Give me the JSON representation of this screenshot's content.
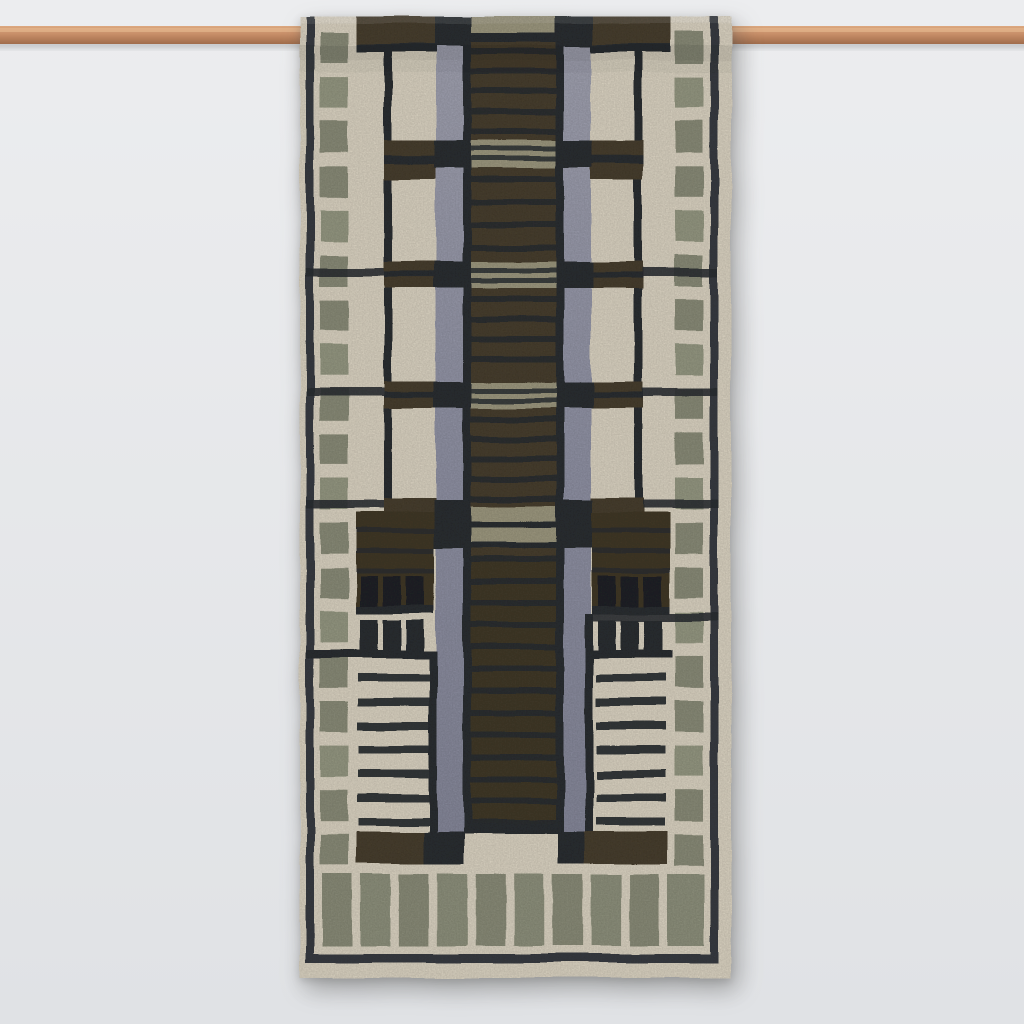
{
  "scene": {
    "type": "product-photograph",
    "subject": "Handwoven geometric kilim wall hanging draped over a copper pipe rail",
    "style": "Art-deco / Frank Lloyd Wright skyscraper motif, mirror-symmetric",
    "background": "plain pale grey studio wall",
    "visible_text": ""
  },
  "palette": {
    "bg_top": "#ecedef",
    "bg_bottom": "#e0e2e5",
    "cream": "#e4dcca",
    "cream_bright": "#ece5d5",
    "cream_shade": "#d8d0be",
    "charcoal": "#2c3034",
    "charcoal_soft": "#3a3e44",
    "pane": "#1f2428",
    "brown": "#4b4130",
    "brown_deep": "#3e3727",
    "brown_block": "#433a29",
    "olive": "#8f917d",
    "olive_light": "#9b9e87",
    "olive_bar": "#939681",
    "tan": "#a39e84",
    "lavender": "#9698ab",
    "lavender_light": "#a7a8b7",
    "lavender_deep": "#8b8da0",
    "copper": "#c78e68",
    "copper_light": "#dca87f",
    "copper_dark": "#a06c4b"
  },
  "rod": {
    "y": 26,
    "height": 18,
    "spans_full_width": true
  },
  "rug": {
    "x": 300,
    "y": 17,
    "width": 431,
    "height": 961,
    "counts": {
      "border_squares_per_side": 19,
      "bottom_bars": 10,
      "window_panes_per_row": 3,
      "window_rows_per_side": 2,
      "ladder_stripes_per_side": 8,
      "tan_cross_bands": 4
    },
    "geometry": {
      "top": 17,
      "bottom": 978,
      "left_edge": 300,
      "right_edge": 731,
      "border_line_w": 8,
      "border_left_x": 306,
      "border_right_x": 710,
      "bottom_line_y": 954,
      "bottom_line_h": 9,
      "squares": {
        "left_x": 320,
        "right_x": 675,
        "w": 28,
        "h": 31,
        "y0": 32,
        "step": 44.6,
        "count": 19
      },
      "inner_line": {
        "left_x": 384,
        "right_x": 634,
        "w": 8,
        "y0": 17,
        "y1": 516
      },
      "lavender_bars": {
        "left_x": 436,
        "right_x": 564,
        "w": 27,
        "y0": 46,
        "y1": 832
      },
      "core": {
        "x": 471,
        "w": 85,
        "edge_w": 8,
        "y0": 17,
        "y1": 834
      },
      "core_stripes": {
        "h": 6,
        "segments": [
          [
            48,
            132,
            20
          ],
          [
            176,
            248,
            23
          ],
          [
            296,
            362,
            20
          ],
          [
            416,
            500,
            20
          ],
          [
            556,
            822,
            22
          ]
        ]
      },
      "tan_bands": [
        {
          "y": 17,
          "h": 16,
          "plain": 1
        },
        {
          "y": 140,
          "h": 28
        },
        {
          "y": 262,
          "h": 26
        },
        {
          "y": 382,
          "h": 26
        }
      ],
      "tan_double": {
        "y1": 506,
        "h1": 15,
        "y2": 527,
        "h2": 15,
        "line_h": 6
      },
      "lav_dark_x": {
        "left": 434,
        "right": 556,
        "w": 37
      },
      "lav_dark_rows": [
        [
          17,
          29
        ],
        [
          140,
          28
        ],
        [
          262,
          26
        ],
        [
          382,
          26
        ],
        [
          500,
          48
        ]
      ],
      "panels": {
        "left_x": 384,
        "right_x": 591,
        "w": 52
      },
      "panel_bands": [
        {
          "y": 140,
          "h": 40
        },
        {
          "y": 262,
          "h": 26
        },
        {
          "y": 382,
          "h": 26
        }
      ],
      "panel_band_e": {
        "y": 498,
        "h": 14
      },
      "top_drape": {
        "y": 17,
        "h": 27,
        "left_x": 356,
        "right_x": 585,
        "w": 86,
        "underline_y": 44,
        "underline_h": 8,
        "core_stripe_y": 33,
        "core_stripe_h": 9
      },
      "cross_lines": [
        {
          "y": 268,
          "kind": "both"
        },
        {
          "y": 388,
          "kind": "both"
        },
        {
          "y": 500,
          "kind": "both"
        },
        {
          "y": 650,
          "kind": "left_long"
        },
        {
          "y": 613,
          "kind": "right_long"
        }
      ],
      "blocks": {
        "left_x": 356,
        "right_x": 592,
        "w": 78,
        "y": 512,
        "h": 102,
        "stripe_ys": [
          528,
          548,
          568
        ],
        "stripe_h": 5,
        "bottom_line_y": 606
      },
      "windows": {
        "pane_w": 18,
        "row1_y": 576,
        "row1_h": 30,
        "row2_y": 620,
        "row2_h": 30,
        "left_xs": [
          360,
          383,
          406
        ],
        "right_xs": [
          598,
          621,
          644
        ],
        "row2_line_y": 650,
        "row2_line_h": 8
      },
      "ladder": {
        "y0": 674,
        "step": 24,
        "count": 8,
        "h": 8,
        "left_x": 358,
        "left_w": 76,
        "right_x": 596,
        "right_w": 70
      },
      "terminal_lines": {
        "left_x": 429,
        "left_y0": 650,
        "right_x": 585,
        "right_y0": 614,
        "y1": 864,
        "w": 8
      },
      "bottom_blocks": {
        "y": 832,
        "h": 32,
        "left_brown": [
          356,
          68
        ],
        "left_dark": [
          424,
          40
        ],
        "right_dark": [
          558,
          26
        ],
        "right_brown": [
          584,
          84
        ]
      },
      "bars": {
        "y": 874,
        "h": 72,
        "x0": 322,
        "x1": 698,
        "count": 10,
        "w": 30
      }
    }
  }
}
